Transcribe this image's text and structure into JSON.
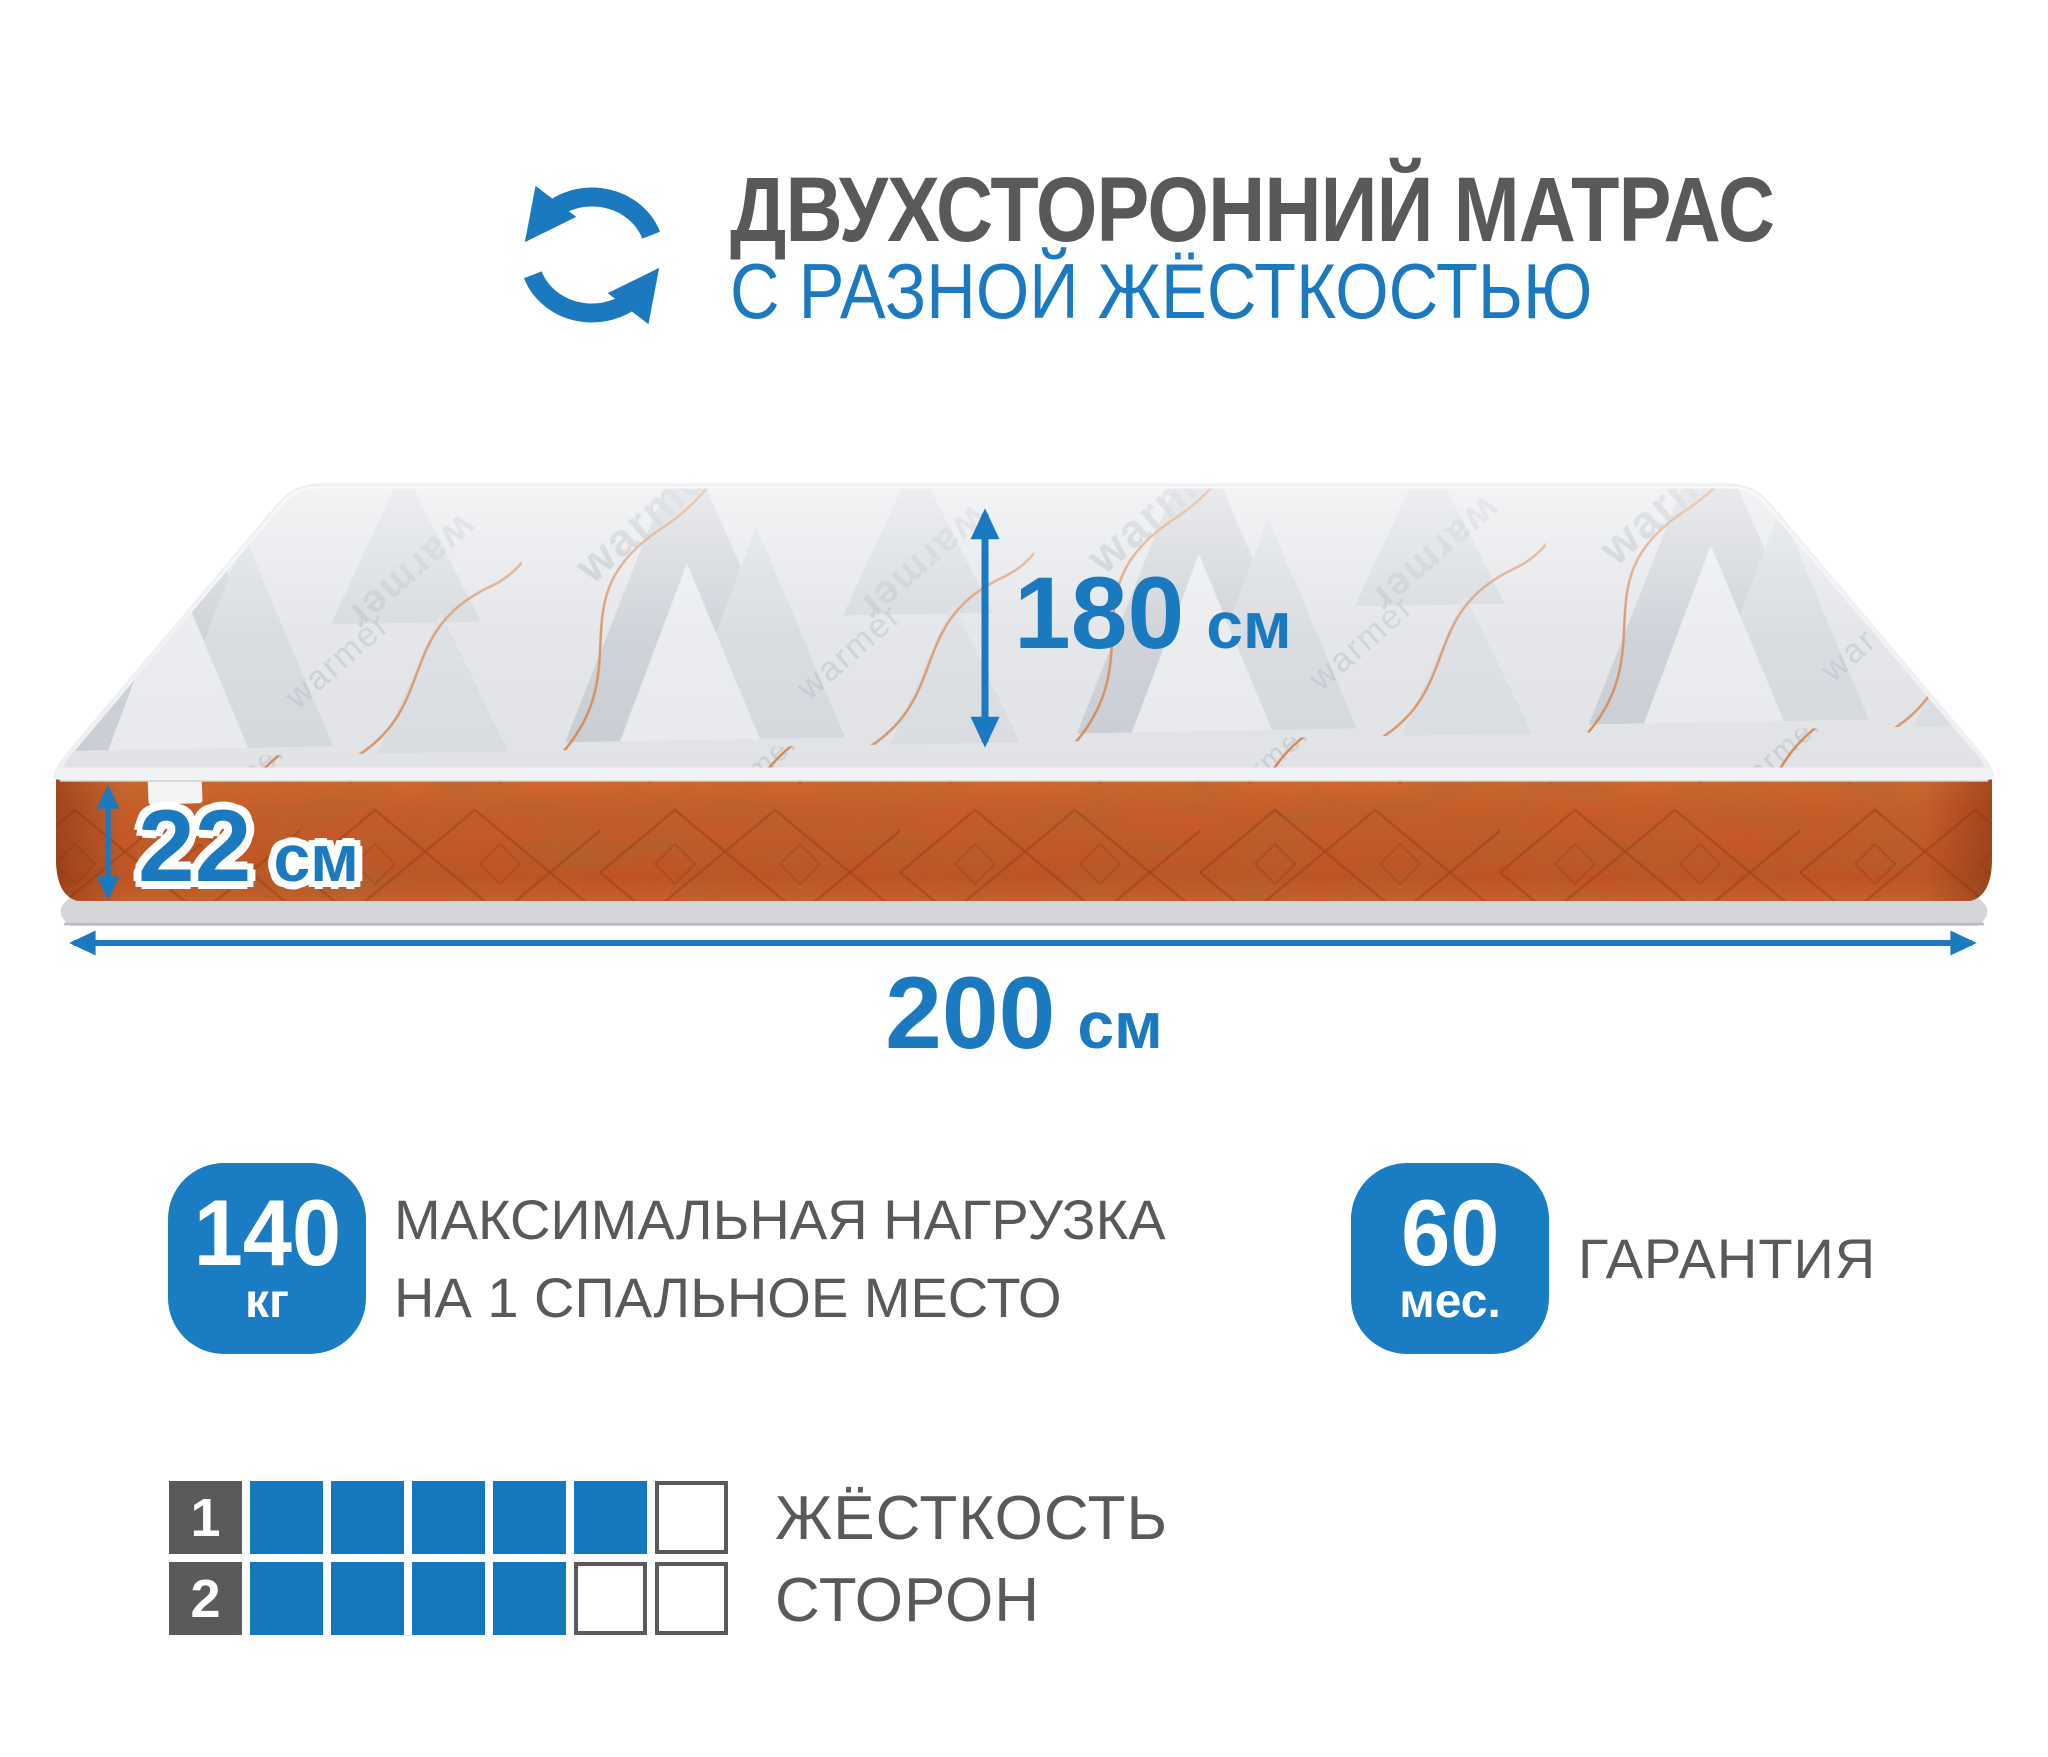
{
  "colors": {
    "accent": "#1b7abf",
    "text_gray": "#58595b",
    "badge_blue": "#1a7cc2",
    "mattress_orange": "#cd5b29"
  },
  "header": {
    "icon": "rotate-arrows-icon",
    "title": "ДВУХСТОРОННИЙ МАТРАС",
    "subtitle": "С РАЗНОЙ ЖЁСТКОСТЬЮ"
  },
  "mattress": {
    "brand_watermark": "warmer",
    "dimensions": {
      "depth": {
        "value": "180",
        "unit": "см"
      },
      "height": {
        "value": "22",
        "unit": "см"
      },
      "width": {
        "value": "200",
        "unit": "см"
      }
    }
  },
  "features": {
    "max_load": {
      "value": "140",
      "unit": "кг",
      "label_line1": "МАКСИМАЛЬНАЯ НАГРУЗКА",
      "label_line2": "НА 1 СПАЛЬНОЕ МЕСТО"
    },
    "warranty": {
      "value": "60",
      "unit": "мес.",
      "label": "ГАРАНТИЯ"
    }
  },
  "firmness_scale": {
    "label_line1": "ЖЁСТКОСТЬ",
    "label_line2": "СТОРОН",
    "cells_total": 6,
    "rows": [
      {
        "side": "1",
        "filled": 5
      },
      {
        "side": "2",
        "filled": 4
      }
    ]
  }
}
